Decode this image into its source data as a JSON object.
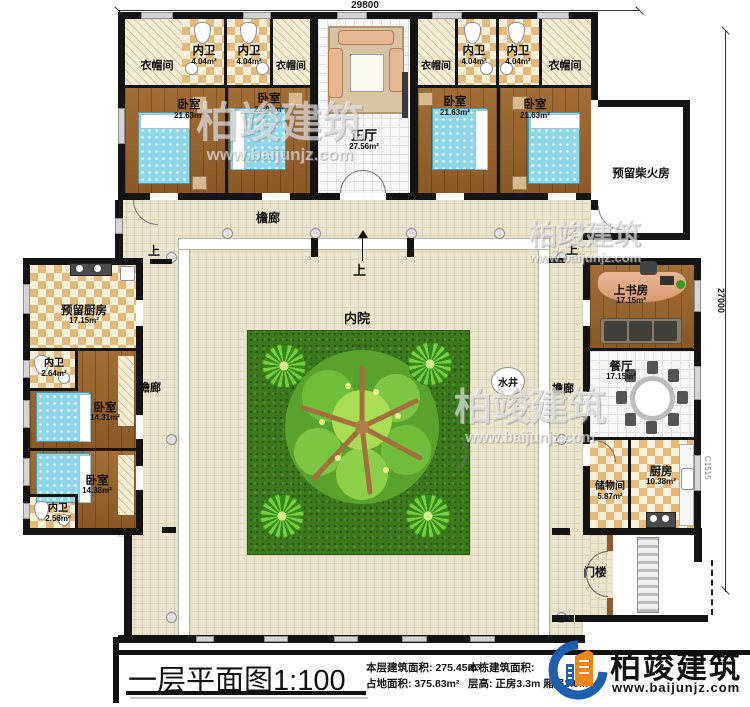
{
  "dims": {
    "top": "29800",
    "right": "27000",
    "window_code": "C1515"
  },
  "labels": {
    "courtyard": "内院",
    "veranda": "檐廊",
    "well": "水井",
    "up": "上"
  },
  "rooms": {
    "hall": {
      "name": "正厅",
      "area": "27.56m²"
    },
    "cloak": {
      "name": "衣帽间"
    },
    "bath_s": {
      "name": "内卫",
      "area": "4.04m²"
    },
    "bed_l": {
      "name": "卧室",
      "area": "21.63m²"
    },
    "kitchen_reserved": {
      "name": "预留厨房",
      "area": "17.15m²"
    },
    "bath_264": {
      "name": "内卫",
      "area": "2.64m²"
    },
    "bed_1431": {
      "name": "卧室",
      "area": "14.31m²"
    },
    "bed_1438": {
      "name": "卧室",
      "area": "14.38m²"
    },
    "bath_256": {
      "name": "内卫",
      "area": "2.56m²"
    },
    "study": {
      "name": "上书房",
      "area": "17.15m²"
    },
    "dining": {
      "name": "餐厅",
      "area": "17.15m²"
    },
    "storage": {
      "name": "储物间",
      "area": "5.87m²"
    },
    "kitchen": {
      "name": "厨房",
      "area": "10.38m²"
    },
    "firewood": {
      "name": "预留柴火房"
    },
    "gate": {
      "name": "门楼"
    }
  },
  "title_block": {
    "title": "一层平面图",
    "scale": "1:100",
    "stats_left": [
      {
        "label": "本层建筑面积:",
        "value": "275.45m²"
      },
      {
        "label": "占地面积:",
        "value": "375.83m²"
      }
    ],
    "stats_right": [
      {
        "label": "本栋建筑面积:",
        "value": ""
      },
      {
        "label": "层高:",
        "value": "正房3.3m 厢房3.0m"
      }
    ]
  },
  "logo": {
    "name": "柏竣建筑",
    "url": "www.baijunjz.com"
  },
  "watermark": {
    "text": "柏竣建筑",
    "url": "www.baijunjz.com"
  }
}
